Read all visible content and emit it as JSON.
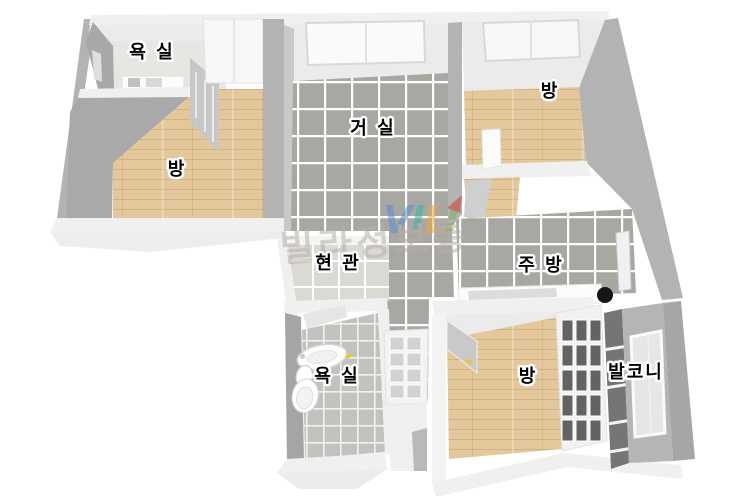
{
  "watermark": {
    "logo_text": "VIL",
    "brand_text": "빌라정보통"
  },
  "rooms": [
    {
      "id": "bathroom-top",
      "label": "욕 실"
    },
    {
      "id": "room-left",
      "label": "방"
    },
    {
      "id": "living-room",
      "label": "거 실"
    },
    {
      "id": "room-top-right",
      "label": "방"
    },
    {
      "id": "entrance",
      "label": "현 관"
    },
    {
      "id": "kitchen",
      "label": "주 방"
    },
    {
      "id": "bathroom-bottom",
      "label": "욕 실"
    },
    {
      "id": "room-bottom-right",
      "label": "방"
    },
    {
      "id": "balcony",
      "label": "발코니"
    }
  ],
  "colors": {
    "wood_floor": "#e4c89b",
    "tile_gray": "#a9a7a1",
    "tile_light": "#dbd9d4",
    "bath_tile": "#c4c2be",
    "wall_side": "#b3b3b3",
    "wall_dark": "#a5a5a5",
    "wall_top": "#f0f0f0",
    "wall_face": "#ebebeb",
    "door_handle_yellow": "#f0c61f",
    "stove_black": "#161616",
    "window_pane_dark": "#636363",
    "logo_blue": "#5b8fd4",
    "logo_teal": "#3fb3a9",
    "logo_orange": "#edaa3f",
    "logo_green": "#7ab648",
    "logo_red": "#d23b2f",
    "brand_gray": "#b5b1aa"
  }
}
